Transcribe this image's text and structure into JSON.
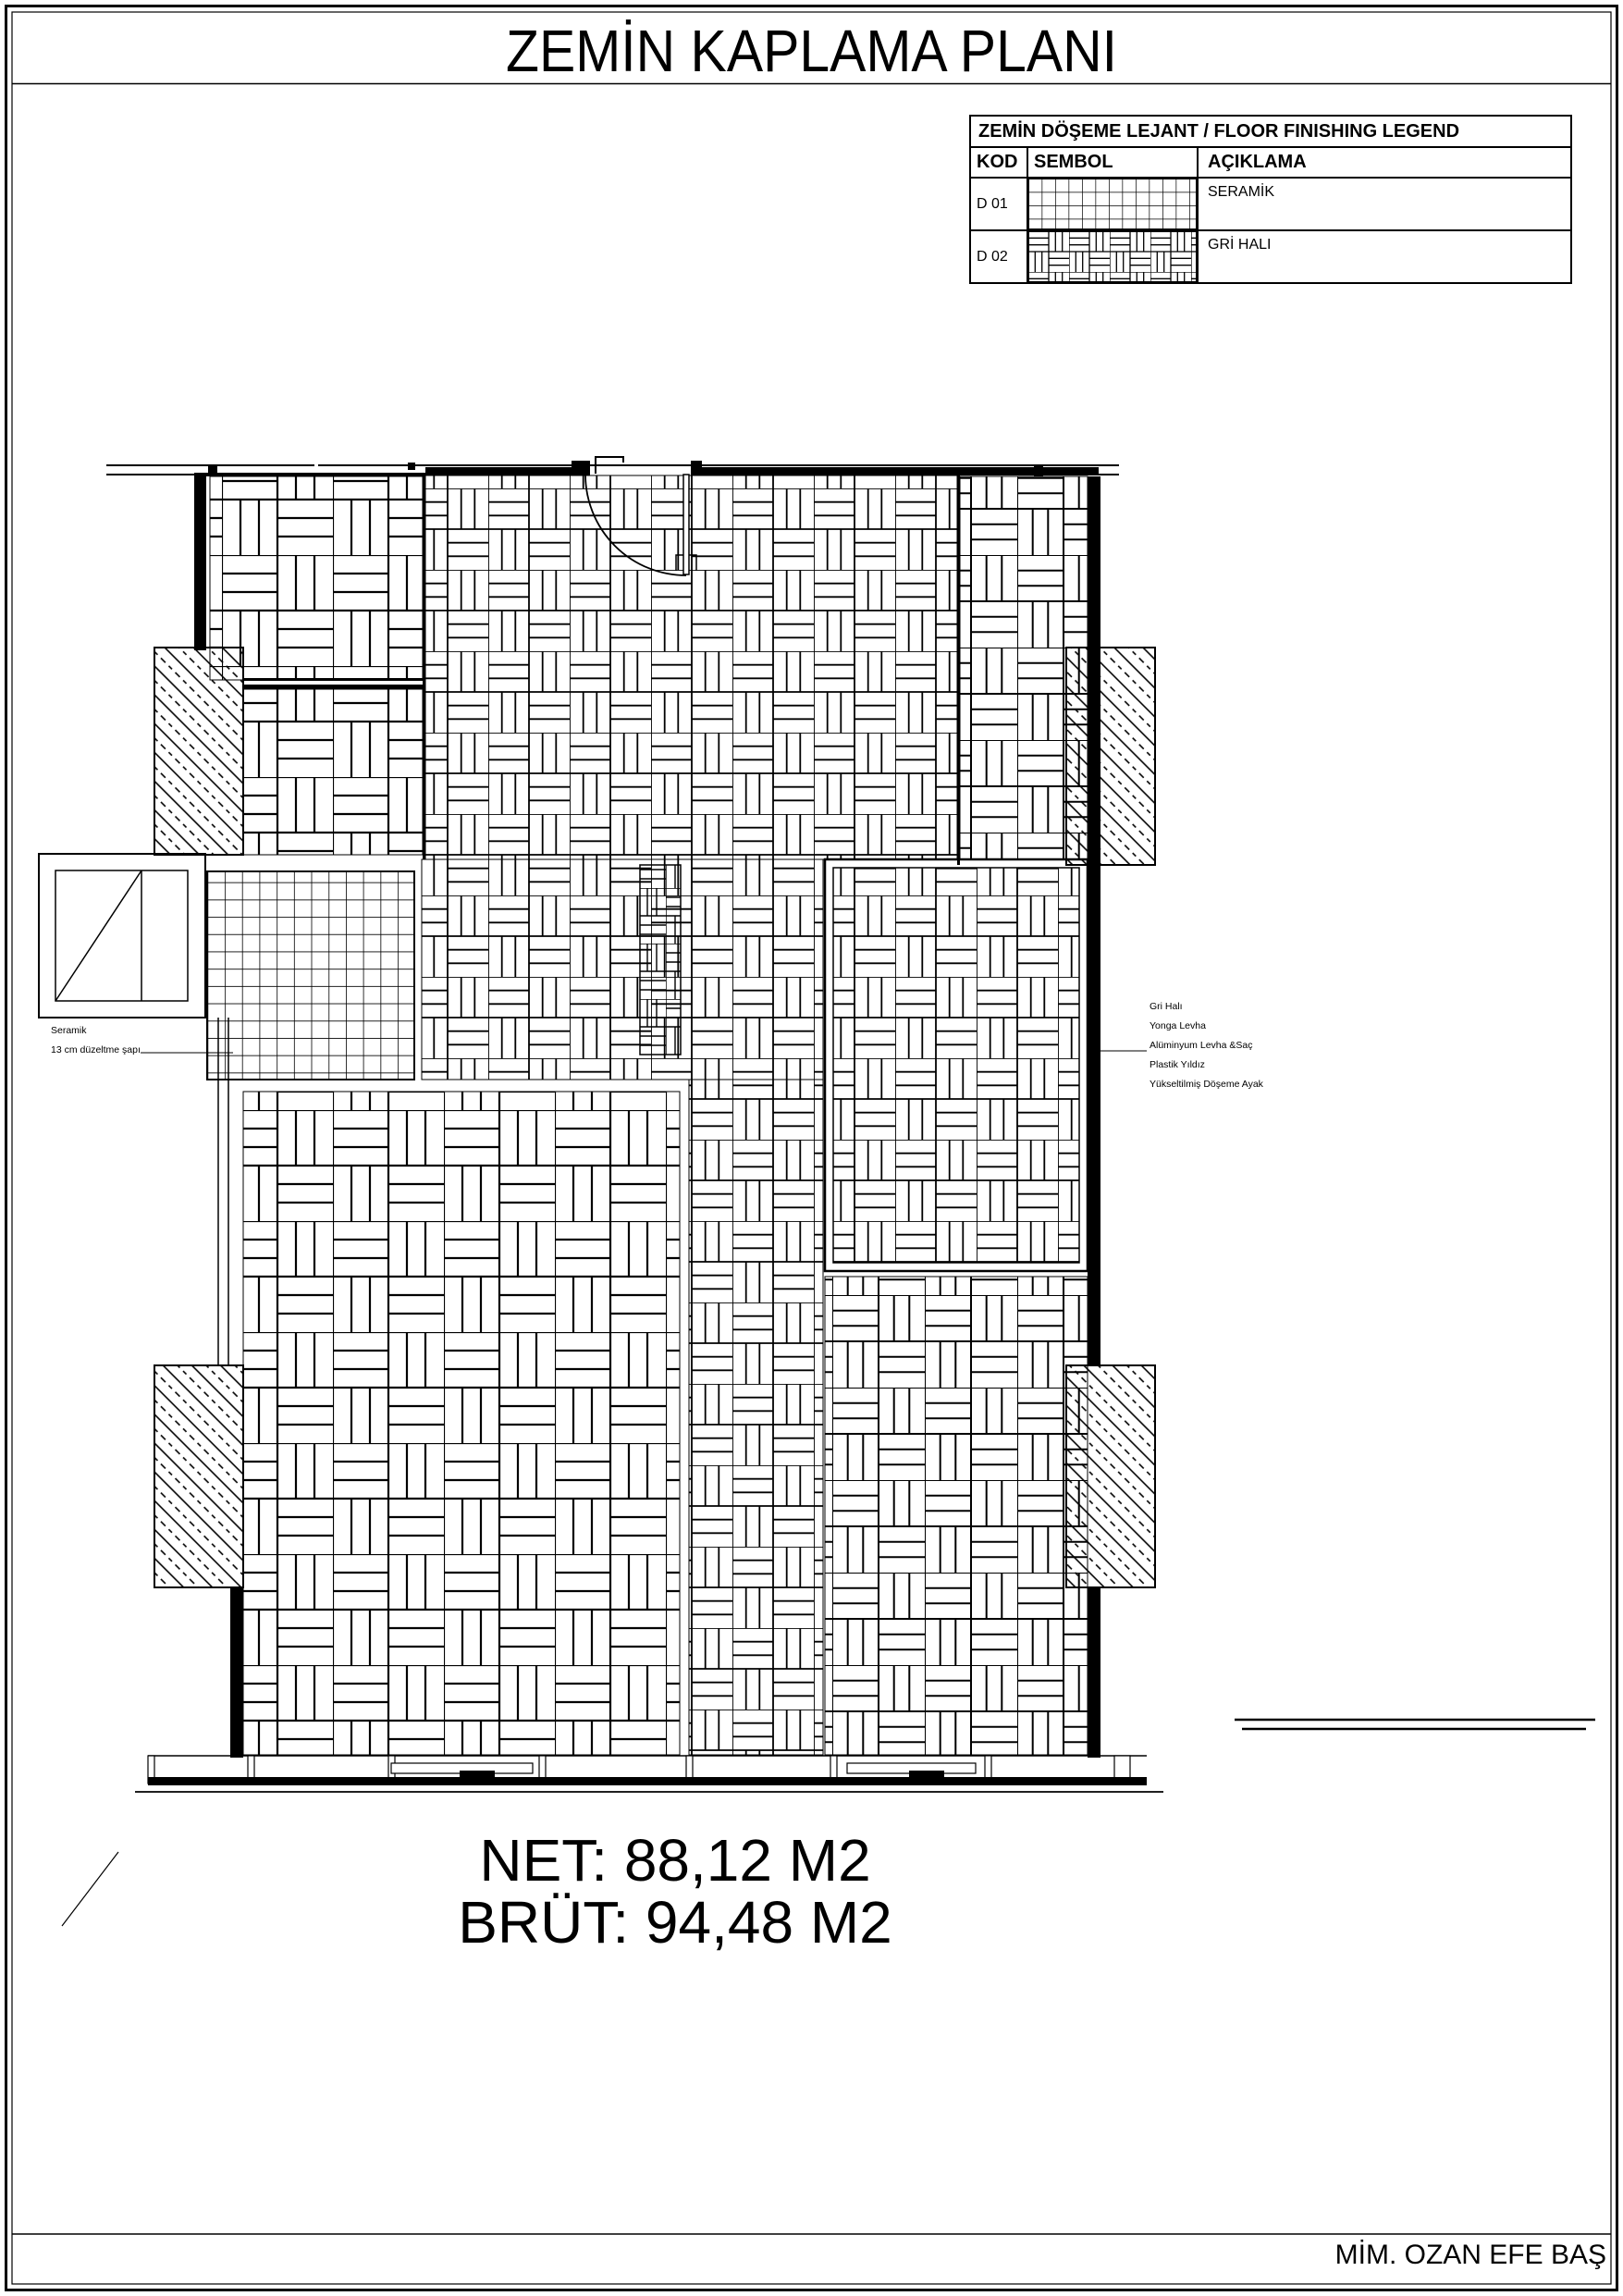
{
  "page": {
    "title": "ZEMİN KAPLAMA PLANI",
    "footer": "MİM. OZAN EFE BAŞ"
  },
  "legend": {
    "title": "ZEMİN DÖŞEME LEJANT / FLOOR FINISHING LEGEND",
    "headers": {
      "kod": "KOD",
      "sembol": "SEMBOL",
      "aciklama": "AÇIKLAMA"
    },
    "rows": [
      {
        "kod": "D 01",
        "symbol": "ceramic-grid-pattern",
        "aciklama": "SERAMİK"
      },
      {
        "kod": "D 02",
        "symbol": "basket-weave-pattern",
        "aciklama": "GRİ HALI"
      }
    ]
  },
  "plan": {
    "left_labels": [
      "Seramik",
      "13 cm düzeltme şapı"
    ],
    "right_labels": [
      "Gri Halı",
      "Yonga Levha",
      "Alüminyum Levha &Saç",
      "Plastik Yıldız",
      "Yükseltilmiş Döşeme Ayak"
    ]
  },
  "areas": {
    "net": "NET: 88,12 M2",
    "brut": "BRÜT: 94,48 M2"
  },
  "colors": {
    "ink": "#000000",
    "paper": "#ffffff"
  }
}
